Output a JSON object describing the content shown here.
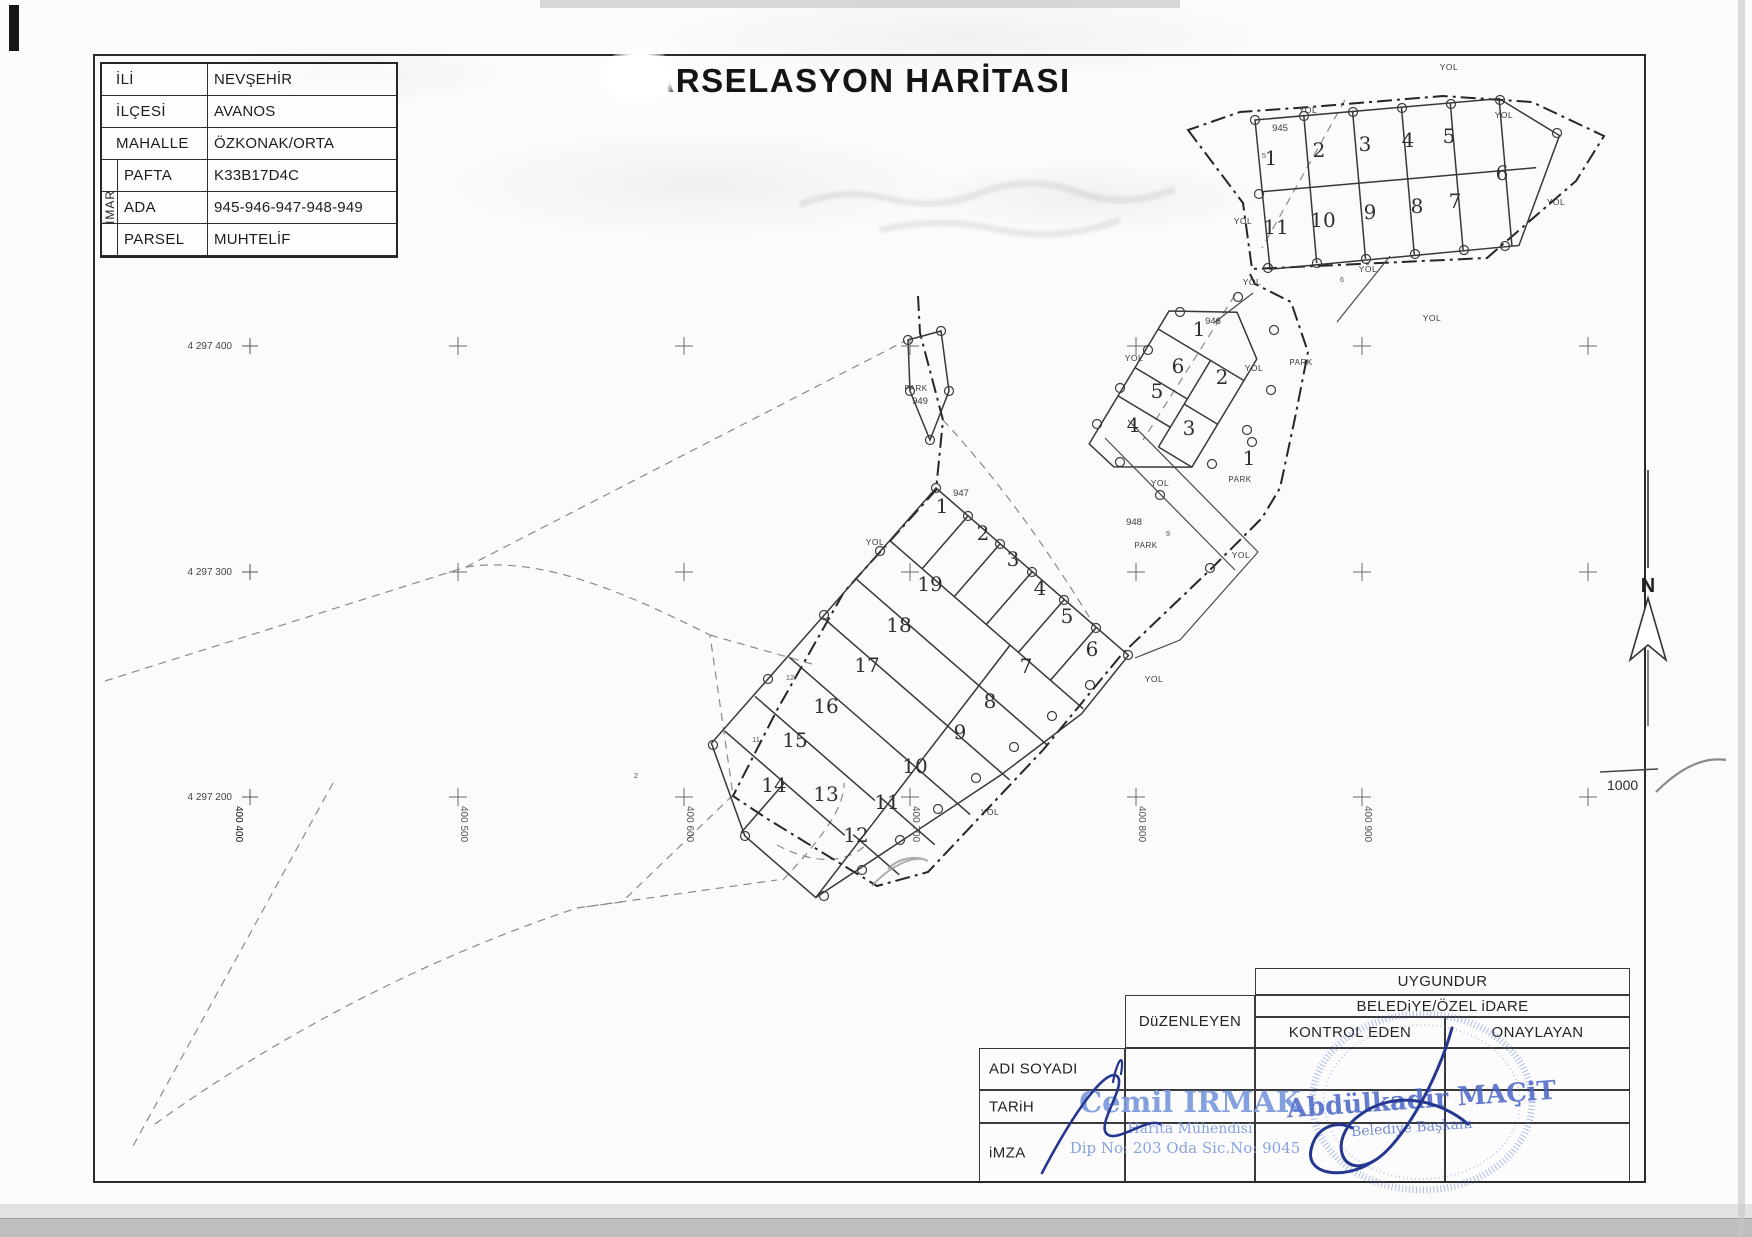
{
  "document": {
    "title": "PARSELASYON HARİTASI",
    "scale": "1000",
    "north_label": "N"
  },
  "info_table": {
    "imar_label": "İMAR",
    "rows": [
      {
        "label": "İLİ",
        "value": "NEVŞEHİR"
      },
      {
        "label": "İLÇESİ",
        "value": "AVANOS"
      },
      {
        "label": "MAHALLE",
        "value": "ÖZKONAK/ORTA"
      },
      {
        "label": "PAFTA",
        "value": "K33B17D4C"
      },
      {
        "label": "ADA",
        "value": "945-946-947-948-949"
      },
      {
        "label": "PARSEL",
        "value": "MUHTELİF"
      }
    ]
  },
  "grid": {
    "northing_labels": [
      {
        "text": "4 297 400",
        "y": 346
      },
      {
        "text": "4 297 300",
        "y": 572
      },
      {
        "text": "4 297 200",
        "y": 797
      }
    ],
    "easting_labels": [
      {
        "text": "400 400",
        "x": 233,
        "dark": true
      },
      {
        "text": "400 500",
        "x": 458
      },
      {
        "text": "400 600",
        "x": 684
      },
      {
        "text": "400 700",
        "x": 910
      },
      {
        "text": "400 800",
        "x": 1136
      },
      {
        "text": "400 900",
        "x": 1362
      }
    ],
    "cross_columns": [
      458,
      684,
      910,
      1136,
      1362,
      1588
    ],
    "cross_rows": [
      346,
      572,
      797
    ],
    "label_cross_x": 250
  },
  "map": {
    "ada_labels": [
      {
        "text": "945",
        "x": 1280,
        "y": 131
      },
      {
        "text": "946",
        "x": 1213,
        "y": 324
      },
      {
        "text": "947",
        "x": 961,
        "y": 496
      },
      {
        "text": "948",
        "x": 1134,
        "y": 525
      },
      {
        "text": "949",
        "x": 920,
        "y": 404
      }
    ],
    "parcel_numbers": [
      {
        "ada": "945",
        "n": "1",
        "x": 1271,
        "y": 165
      },
      {
        "ada": "945",
        "n": "2",
        "x": 1319,
        "y": 157
      },
      {
        "ada": "945",
        "n": "3",
        "x": 1365,
        "y": 151
      },
      {
        "ada": "945",
        "n": "4",
        "x": 1408,
        "y": 147
      },
      {
        "ada": "945",
        "n": "5",
        "x": 1449,
        "y": 143
      },
      {
        "ada": "945",
        "n": "6",
        "x": 1502,
        "y": 180
      },
      {
        "ada": "945",
        "n": "7",
        "x": 1455,
        "y": 208
      },
      {
        "ada": "945",
        "n": "8",
        "x": 1417,
        "y": 213
      },
      {
        "ada": "945",
        "n": "9",
        "x": 1370,
        "y": 219
      },
      {
        "ada": "945",
        "n": "10",
        "x": 1323,
        "y": 227
      },
      {
        "ada": "945",
        "n": "11",
        "x": 1276,
        "y": 234
      },
      {
        "ada": "946",
        "n": "1",
        "x": 1199,
        "y": 336
      },
      {
        "ada": "946",
        "n": "2",
        "x": 1222,
        "y": 384
      },
      {
        "ada": "946",
        "n": "3",
        "x": 1189,
        "y": 435
      },
      {
        "ada": "946",
        "n": "4",
        "x": 1133,
        "y": 432
      },
      {
        "ada": "946",
        "n": "5",
        "x": 1157,
        "y": 398
      },
      {
        "ada": "946",
        "n": "6",
        "x": 1178,
        "y": 373
      },
      {
        "ada": "947",
        "n": "1",
        "x": 942,
        "y": 513
      },
      {
        "ada": "947",
        "n": "2",
        "x": 983,
        "y": 540
      },
      {
        "ada": "947",
        "n": "3",
        "x": 1013,
        "y": 566
      },
      {
        "ada": "947",
        "n": "4",
        "x": 1040,
        "y": 595
      },
      {
        "ada": "947",
        "n": "5",
        "x": 1067,
        "y": 623
      },
      {
        "ada": "947",
        "n": "6",
        "x": 1092,
        "y": 656
      },
      {
        "ada": "947",
        "n": "7",
        "x": 1026,
        "y": 673
      },
      {
        "ada": "947",
        "n": "8",
        "x": 990,
        "y": 708
      },
      {
        "ada": "947",
        "n": "9",
        "x": 960,
        "y": 739
      },
      {
        "ada": "947",
        "n": "10",
        "x": 915,
        "y": 773
      },
      {
        "ada": "947",
        "n": "11",
        "x": 887,
        "y": 809
      },
      {
        "ada": "947",
        "n": "12",
        "x": 856,
        "y": 842
      },
      {
        "ada": "947",
        "n": "13",
        "x": 826,
        "y": 801
      },
      {
        "ada": "947",
        "n": "14",
        "x": 774,
        "y": 792
      },
      {
        "ada": "947",
        "n": "15",
        "x": 795,
        "y": 747
      },
      {
        "ada": "947",
        "n": "16",
        "x": 826,
        "y": 713
      },
      {
        "ada": "947",
        "n": "17",
        "x": 867,
        "y": 672
      },
      {
        "ada": "947",
        "n": "18",
        "x": 899,
        "y": 632
      },
      {
        "ada": "947",
        "n": "19",
        "x": 930,
        "y": 591
      },
      {
        "ada": "948",
        "n": "1",
        "x": 1249,
        "y": 465
      }
    ],
    "road_labels": [
      {
        "text": "YOL",
        "x": 1449,
        "y": 70
      },
      {
        "text": "YOL",
        "x": 1308,
        "y": 113
      },
      {
        "text": "YOL",
        "x": 1504,
        "y": 118
      },
      {
        "text": "YOL",
        "x": 1556,
        "y": 205
      },
      {
        "text": "YOL",
        "x": 1243,
        "y": 224
      },
      {
        "text": "YOL",
        "x": 1252,
        "y": 285
      },
      {
        "text": "YOL",
        "x": 1368,
        "y": 272
      },
      {
        "text": "YOL",
        "x": 1432,
        "y": 321
      },
      {
        "text": "YOL",
        "x": 1134,
        "y": 361
      },
      {
        "text": "YOL",
        "x": 1254,
        "y": 371
      },
      {
        "text": "YOL",
        "x": 1160,
        "y": 486
      },
      {
        "text": "YOL",
        "x": 1241,
        "y": 558
      },
      {
        "text": "YOL",
        "x": 875,
        "y": 545
      },
      {
        "text": "YOL",
        "x": 1154,
        "y": 682
      },
      {
        "text": "YOL",
        "x": 990,
        "y": 815
      }
    ],
    "park_labels": [
      {
        "text": "PARK",
        "x": 1301,
        "y": 365
      },
      {
        "text": "PARK",
        "x": 1240,
        "y": 482
      },
      {
        "text": "PARK",
        "x": 1146,
        "y": 548
      },
      {
        "text": "PARK",
        "x": 916,
        "y": 391
      }
    ],
    "tiny_labels": [
      {
        "text": "5",
        "x": 1264,
        "y": 158
      },
      {
        "text": "6",
        "x": 1342,
        "y": 282
      },
      {
        "text": "9",
        "x": 1168,
        "y": 536
      },
      {
        "text": "12",
        "x": 790,
        "y": 680
      },
      {
        "text": "11",
        "x": 756,
        "y": 742
      },
      {
        "text": "2",
        "x": 636,
        "y": 778
      }
    ]
  },
  "approval_table": {
    "uygundur": "UYGUNDUR",
    "belediye": "BELEDiYE/ÖZEL iDARE",
    "duzenleyen": "DüZENLEYEN",
    "kontrol_eden": "KONTROL EDEN",
    "onaylayan": "ONAYLAYAN",
    "rows": [
      "ADI SOYADI",
      "TARiH",
      "iMZA"
    ]
  },
  "stamps": {
    "engineer": {
      "name": "Cemil IRMAK",
      "title": "Harita Mühendisi",
      "registration": "Dip No: 203 Oda Sic.No: 9045"
    },
    "mayor": {
      "name": "Abdülkadir MAÇiT",
      "title": "Belediye Başkanı"
    }
  },
  "colors": {
    "line": "#2e2e2e",
    "dashed": "#8a8a8a",
    "grid": "#6a6a6a",
    "stamp_blue_light": "#7b99dd",
    "stamp_blue": "#4a66c8",
    "signature_blue": "#24368f"
  }
}
